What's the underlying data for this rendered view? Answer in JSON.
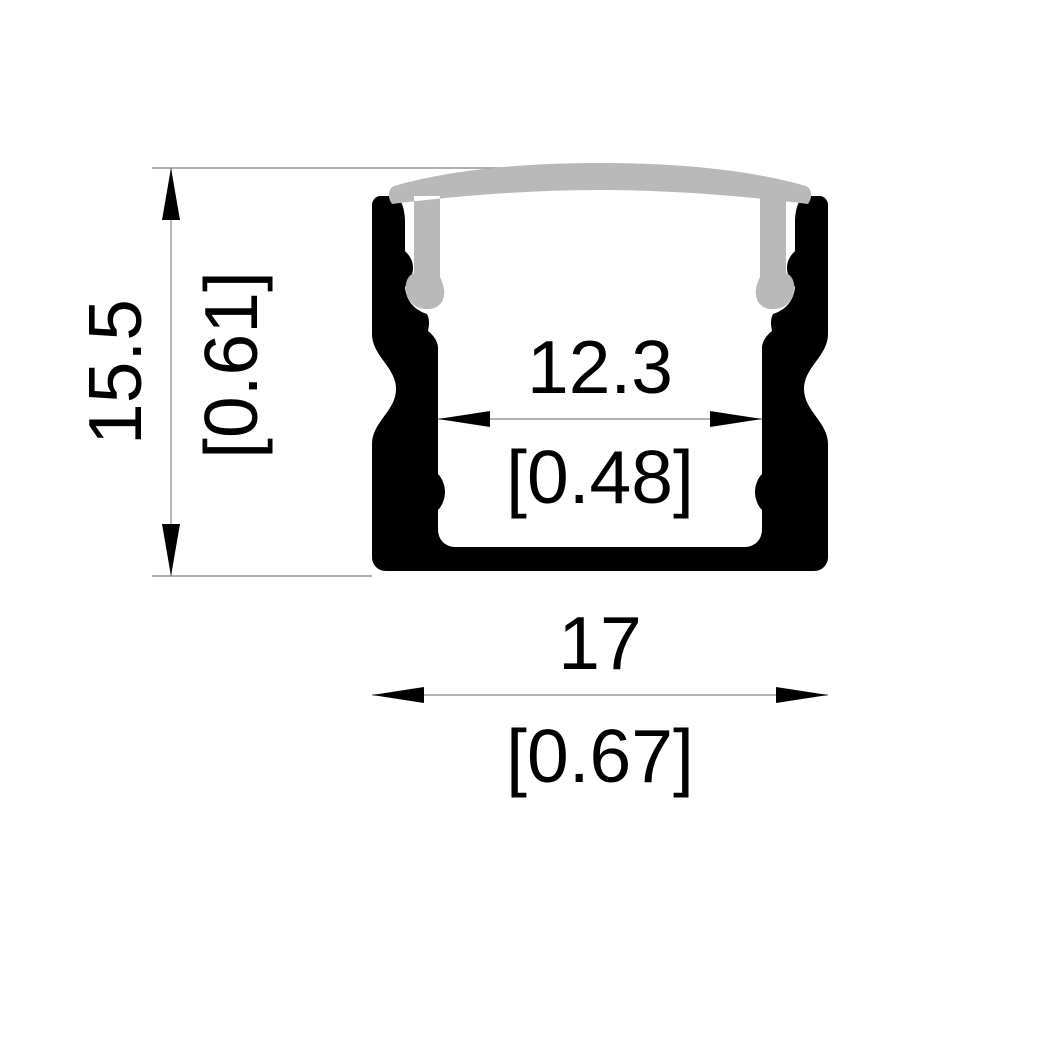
{
  "drawing": {
    "kind": "led-profile-cross-section",
    "dimensions": {
      "height": {
        "mm": "15.5",
        "inches": "[0.61]"
      },
      "inner_width": {
        "mm": "12.3",
        "inches": "[0.48]"
      },
      "outer_width": {
        "mm": "17",
        "inches": "[0.67]"
      }
    }
  },
  "colors": {
    "background": "#ffffff",
    "profile_black": "#000000",
    "cover_gray": "#b9b9b9",
    "dim_line": "#969696"
  }
}
